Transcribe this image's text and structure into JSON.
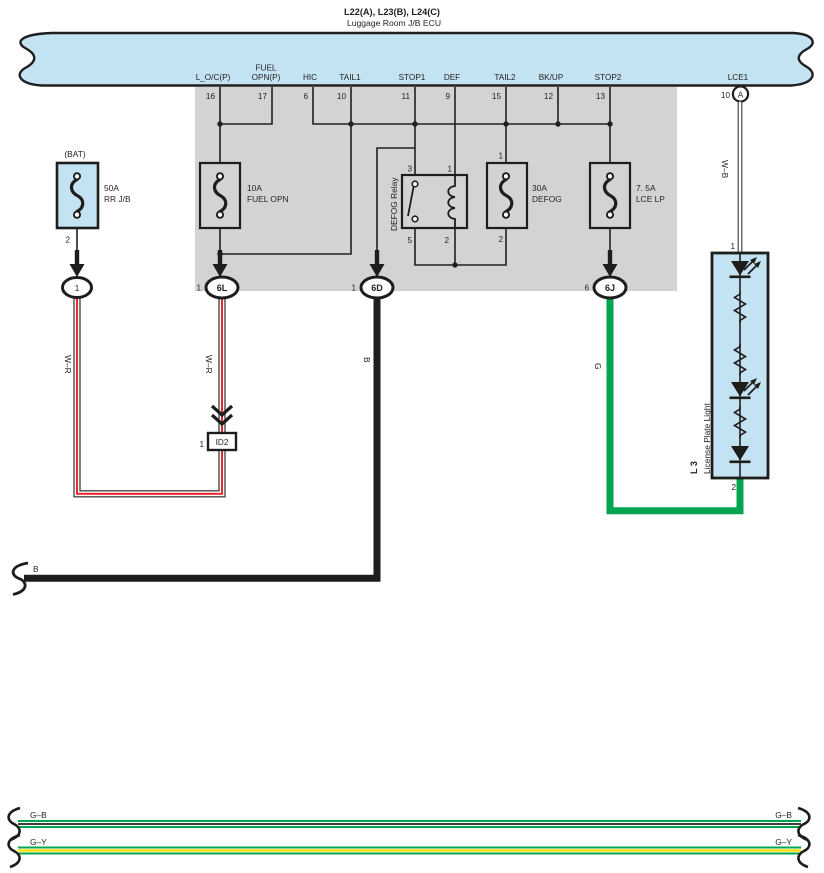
{
  "header": {
    "title": "L22(A), L23(B), L24(C)",
    "subtitle": "Luggage Room J/B ECU"
  },
  "colors": {
    "band_blue": "#c3e3f2",
    "jb_gray": "#d3d3d3",
    "wire_black": "#1d1d1b",
    "wire_green": "#00a551",
    "wire_red": "#ed1c24",
    "wire_yellow": "#ffe100",
    "wire_outline_gray": "#4a4a48"
  },
  "ecu": {
    "pins": [
      {
        "label": "L_O/C(P)",
        "number": "16"
      },
      {
        "label_top": "FUEL",
        "label_bottom": "OPN(P)",
        "number": "17"
      },
      {
        "label": "HIC",
        "number": "6"
      },
      {
        "label": "TAIL1",
        "number": "10"
      },
      {
        "label": "STOP1",
        "number": "11"
      },
      {
        "label": "DEF",
        "number": "9"
      },
      {
        "label": "TAIL2",
        "number": "15"
      },
      {
        "label": "BK/UP",
        "number": "12"
      },
      {
        "label": "STOP2",
        "number": "13"
      },
      {
        "label": "LCE1",
        "number": "10"
      }
    ]
  },
  "battery_fuse": {
    "tag": "(BAT)",
    "rating": "50A",
    "name": "RR J/B",
    "pin": "2",
    "connector": "1"
  },
  "jb": {
    "fuel_fuse": {
      "rating": "10A",
      "name": "FUEL OPN"
    },
    "defog_relay": {
      "name": "DEFOG Relay",
      "pin_tl": "3",
      "pin_tr": "1",
      "pin_bl": "5",
      "pin_br": "2"
    },
    "defog_fuse": {
      "rating": "30A",
      "name": "DEFOG",
      "pin_top": "1",
      "pin_bottom": "2"
    },
    "lce_fuse": {
      "rating": "7. 5A",
      "name": "LCE LP"
    },
    "connectors": {
      "c6l_pin": "1",
      "c6l": "6L",
      "c6d_pin": "1",
      "c6d": "6D",
      "c6j_pin": "6",
      "c6j": "6J"
    }
  },
  "lce_connector": {
    "code": "A"
  },
  "id2": {
    "pin": "1",
    "code": "ID2"
  },
  "license_plate_light": {
    "code": "L 3",
    "name": "License Plate Light",
    "pin_top": "1",
    "pin_bottom": "2"
  },
  "wire_labels": {
    "wr_left": "W–R",
    "wr_right": "W–R",
    "b_vertical": "B",
    "g": "G",
    "wb": "W–B",
    "b_horizontal": "B",
    "gb_left": "G–B",
    "gb_right": "G–B",
    "gy_left": "G–Y",
    "gy_right": "G–Y"
  }
}
